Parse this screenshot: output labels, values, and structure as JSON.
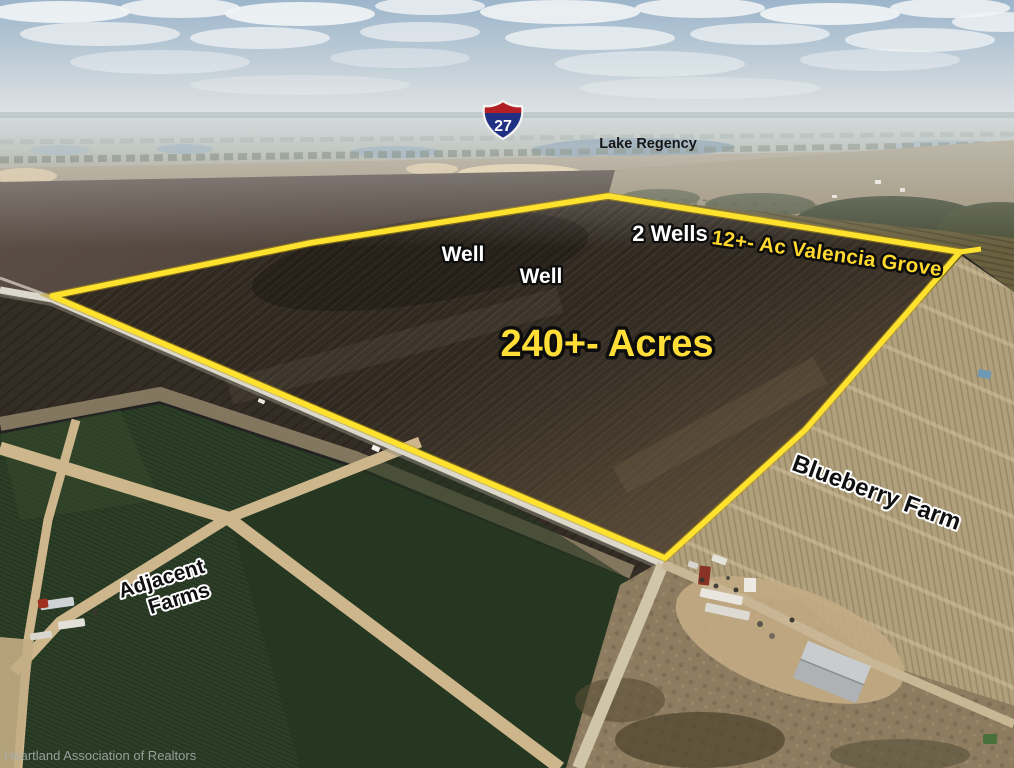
{
  "labels": {
    "route_number": "27",
    "lake": "Lake Regency",
    "two_wells": "2 Wells",
    "well_a": "Well",
    "well_b": "Well",
    "valencia_grove": "12+- Ac Valencia Grove",
    "acreage": "240+- Acres",
    "blueberry_farm": "Blueberry Farm",
    "adjacent_line1": "Adjacent",
    "adjacent_line2": "Farms",
    "watermark": "Heartland Association of Realtors"
  },
  "colors": {
    "boundary_yellow": "#FFE22E",
    "label_yellow": "#FFD92E",
    "acreage_yellow": "#FFDF37",
    "label_white": "#FFFFFF",
    "label_black": "#101010",
    "shield_red": "#B22026",
    "shield_blue": "#203183",
    "dark_field": "#322B22",
    "green_field": "#2C3E27",
    "blueberry_rows": "#B0A07C"
  }
}
